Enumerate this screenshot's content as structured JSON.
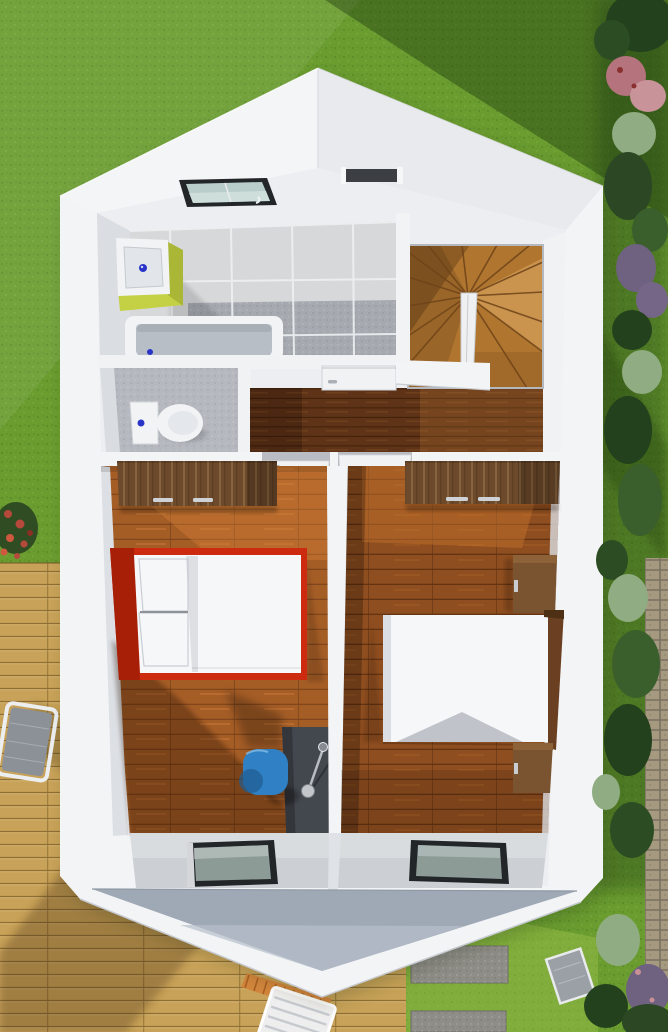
{
  "scene": {
    "description": "Top-down 3D render of an upper-floor house plan with bathroom, WC, winder staircase, landing and two bedrooms, surrounded by lawn, wooden deck, paver path and shrubs",
    "rooms": [
      "bathroom",
      "wc",
      "stairwell",
      "landing-hallway",
      "bedroom-left",
      "bedroom-right"
    ],
    "fixtures": [
      "skylight-window",
      "vanity-sink",
      "bathtub",
      "toilet",
      "winder-stairs",
      "bathroom-door",
      "bedroom-door-left",
      "bedroom-door-right",
      "window-bedroom-left",
      "window-bedroom-right"
    ],
    "furniture": [
      "wardrobe-left",
      "double-bed-red",
      "desk",
      "desk-lamp",
      "blue-chair",
      "wardrobe-right",
      "nightstand-top",
      "double-bed-right",
      "nightstand-bottom"
    ],
    "outdoor": [
      "lawn",
      "wood-deck",
      "sun-lounger-left",
      "sun-lounger-bottom",
      "orange-fringe-mat",
      "stone-slabs",
      "paver-path",
      "shrub-row",
      "red-flowers",
      "garden-chair-right"
    ]
  },
  "colors": {
    "grass_base": "#6a9c30",
    "grass_light": "#87b545",
    "grass_shadow": "#0c2405",
    "deck_wood": "#c8a258",
    "deck_line": "#8f6f35",
    "paver": "#a59a80",
    "paver_gap": "#7c7262",
    "slab": "#8f8d88",
    "bush_dark": "#24411d",
    "bush_mid": "#3a5f2c",
    "bush_sage": "#90ac82",
    "bush_pink": "#b5737d",
    "bush_purple": "#6f6180",
    "flower_red": "#b54a3c",
    "house_white": "#f3f4f6",
    "roof_left": "#f4f5f7",
    "roof_right": "#e8eaed",
    "roof_edge": "#dcdee2",
    "wall_inner": "#eceef1",
    "wall_shade": "#cfd3d8",
    "wall_dark": "#b9bdc3",
    "slope_gray": "#9fa9b6",
    "slope_gray_light": "#b7bfca",
    "band_gray": "#ccd0d5",
    "tile_light": "#d6d8da",
    "tile_grout": "#eef0f2",
    "tile_dark": "#a6aab0",
    "tub_inner": "#b8bec6",
    "fixture_white": "#f1f3f5",
    "sink_lime": "#c5d145",
    "sink_lime_dark": "#a9b636",
    "faucet_blue": "#2a35c8",
    "wc_floor": "#b5b9bf",
    "wood_hall": "#5f3317",
    "wood_hall_line": "#3f2008",
    "wood_stair": "#b0752f",
    "stair_line": "#6e4318",
    "wood_bedl": "#a55d26",
    "wood_bedl_line": "#7c421a",
    "wood_bedr": "#8f4e1f",
    "wood_bedr_line": "#5e2f10",
    "wardrobe": "#6d4a2c",
    "wardrobe_grain": "#8f6a42",
    "wardrobe_dark": "#54371c",
    "bed_red": "#cd2b10",
    "bed_red_dark": "#a81f08",
    "bedding": "#f6f7f9",
    "bedding_shade": "#c9cdd3",
    "desk_dark": "#43474e",
    "desk_side": "#33363b",
    "lamp_silver": "#c3c7cc",
    "chair_blue": "#2f80c4",
    "chair_blue_dark": "#1f5c92",
    "nightstand": "#7a5430",
    "bedframe": "#6b4022",
    "window_frame": "#232629",
    "window_glass": "#8d9b97",
    "sky_glass": "#b9cdca",
    "sky_glass_light": "#d3e2df",
    "door_white": "#f1f2f4",
    "handle": "#aab0b6",
    "fringe_orange": "#d2853c",
    "lounger_gray": "#8b9197"
  }
}
